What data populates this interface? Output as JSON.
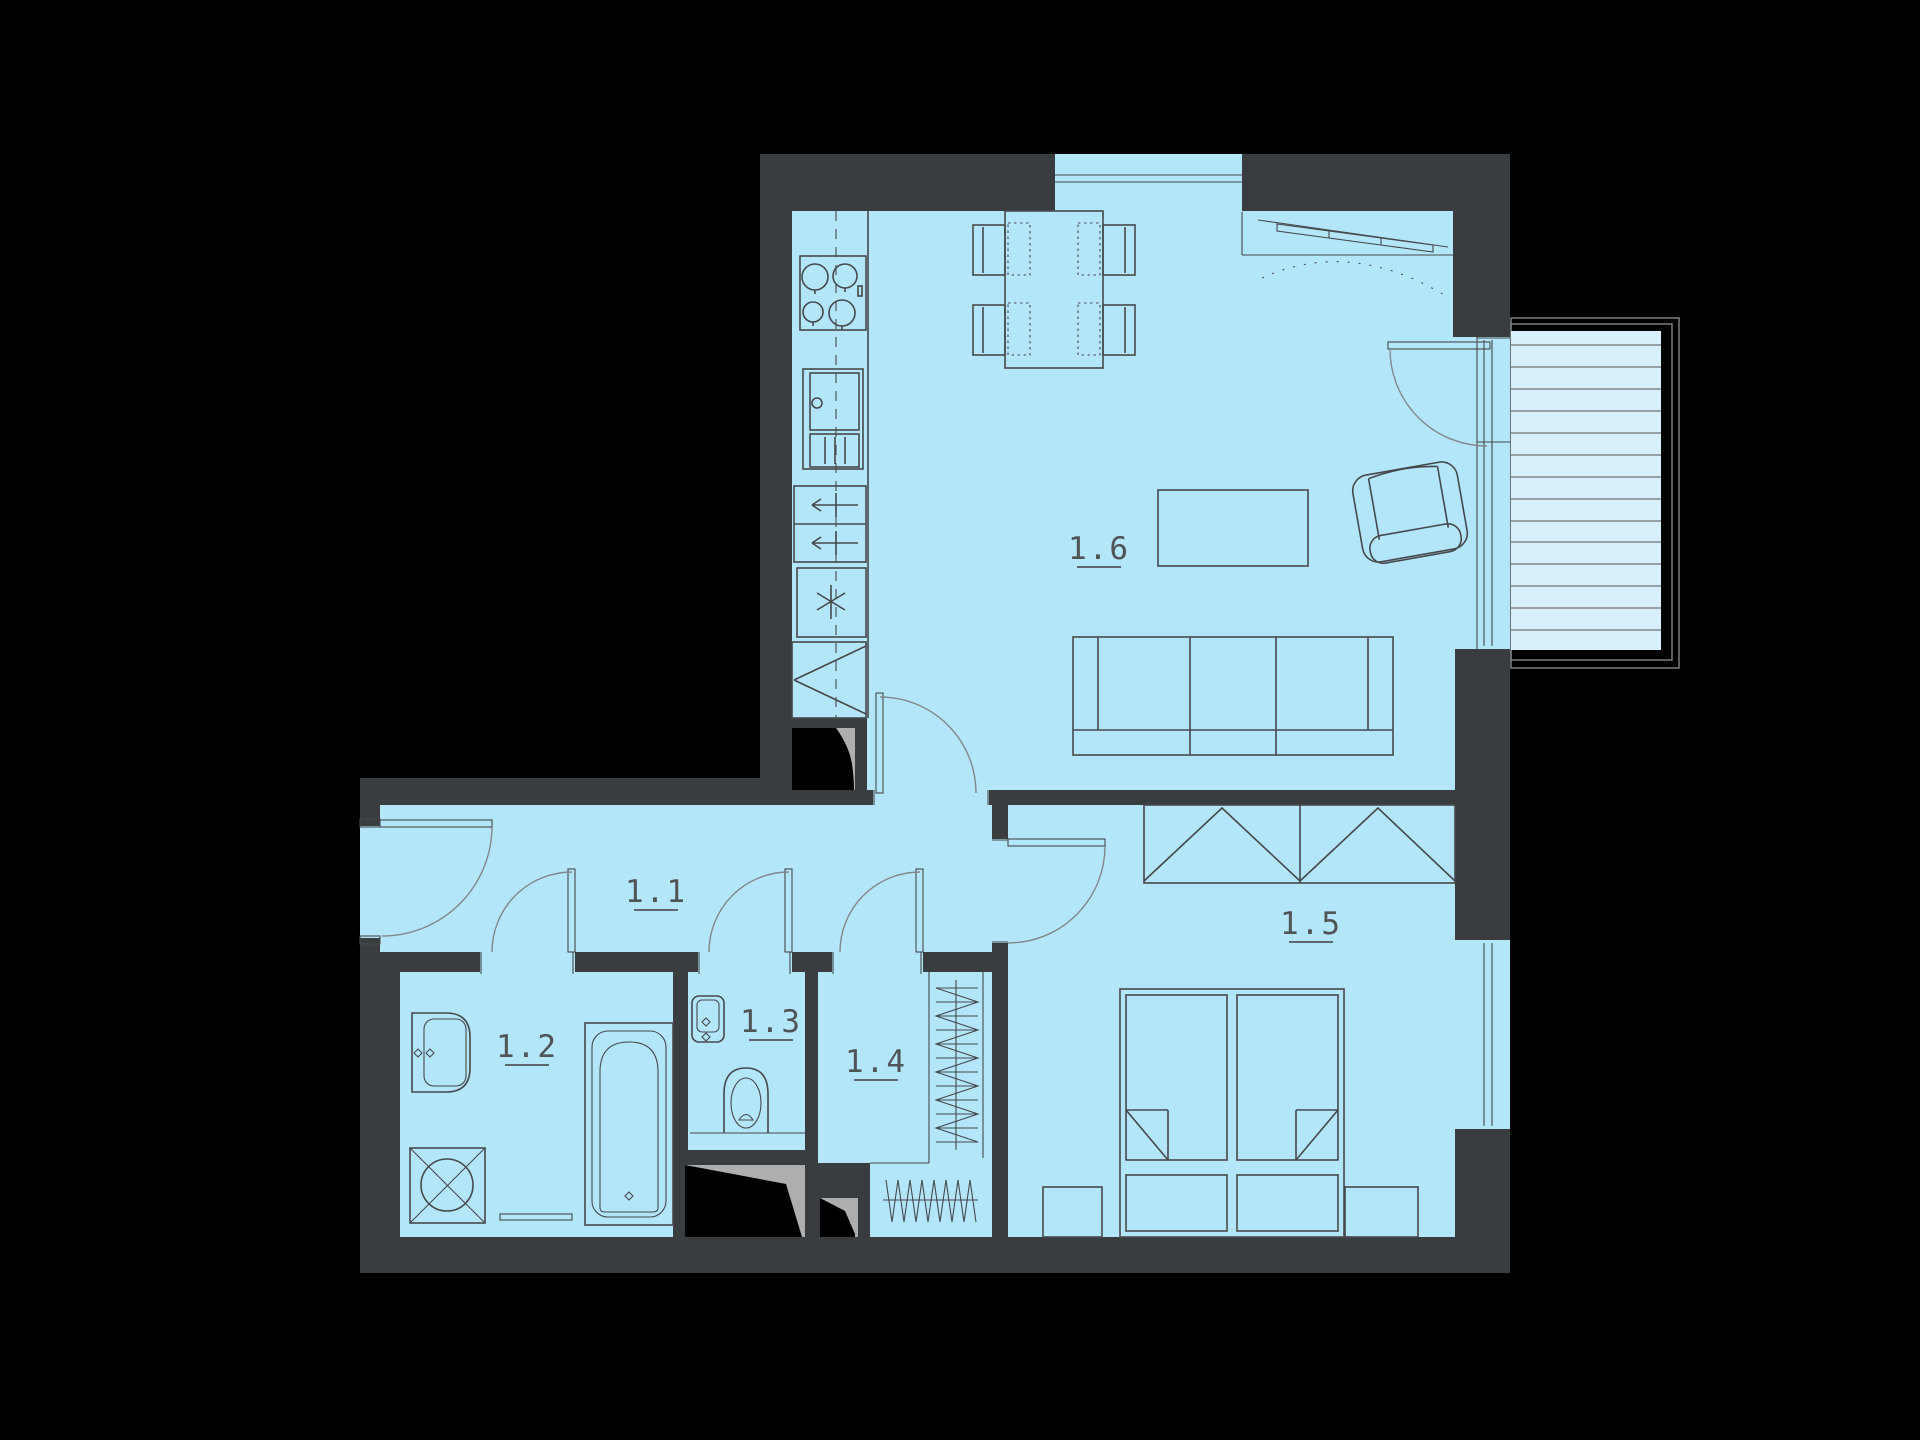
{
  "colors": {
    "wall": "#3a3d3f",
    "floor": "#b4e6fa",
    "balcony_floor": "#d8f0fc",
    "line": "#46494c",
    "door_arc": "#83878a",
    "shaft_gray": "#aeaeae",
    "label": "#505457",
    "background": "#000000"
  },
  "floor_plan": {
    "rooms": [
      {
        "label": "1.1"
      },
      {
        "label": "1.2"
      },
      {
        "label": "1.3"
      },
      {
        "label": "1.4"
      },
      {
        "label": "1.5"
      },
      {
        "label": "1.6"
      }
    ],
    "features": [
      "balcony",
      "entry-door",
      "balcony-door",
      "windows",
      "kitchen-stove",
      "kitchen-fridge",
      "kitchen-drawers",
      "kitchen-freezer",
      "corner-cabinet",
      "dining-table",
      "chairs",
      "sofa",
      "coffee-table",
      "armchair",
      "sliding-door",
      "wardrobe",
      "double-bed",
      "nightstands",
      "bathtub",
      "wash-basin",
      "washing-machine",
      "bath-mat",
      "toilet",
      "corner-basin",
      "drying-racks",
      "ventilation-shafts"
    ]
  }
}
